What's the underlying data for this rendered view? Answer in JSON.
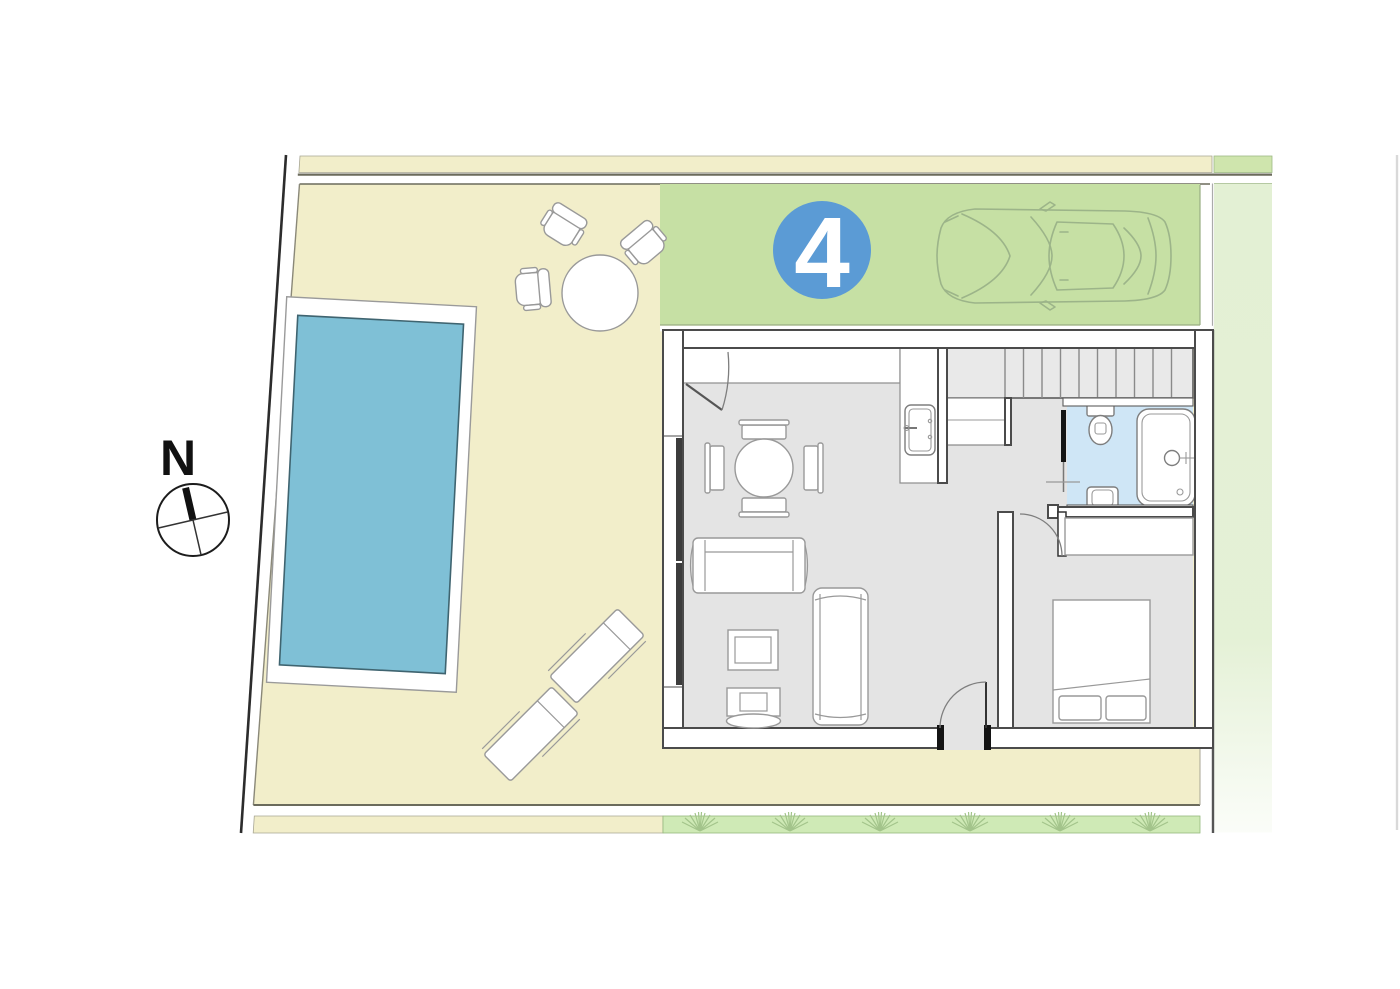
{
  "site": {
    "unit_number": "4",
    "north_label": "N"
  },
  "legend": {
    "plot": "walled garden plot with pool, dining terrace and sun deck",
    "parking": "private parking bay with car",
    "house": "one-bedroom villa ground floor: living-dining room, kitchen, stairs, bathroom, bedroom"
  },
  "colors": {
    "yard": "#f2eeca",
    "yard_line": "#6b6b5c",
    "parking_green": "#c6e0a4",
    "parking_edge": "#98ad83",
    "strip_green": "#cfe5ad",
    "right_strip": "#e3f0d4",
    "tuft_strip": "#cfeab6",
    "tuft": "#a3c48b",
    "pool": "#7fc0d6",
    "pool_edge": "#3f6470",
    "bathroom": "#cfe6f6",
    "floor": "#e4e4e4",
    "stairs_fill": "#e9e9e9",
    "stair_line": "#8a8a8a",
    "wall": "#4b4b4b",
    "furniture_line": "#999999",
    "car_line": "#9cb489",
    "badge_blue": "#5b9bd5",
    "ink": "#141414",
    "boundary": "#2c2c2c",
    "neighbor_line": "#d9d9d9"
  }
}
